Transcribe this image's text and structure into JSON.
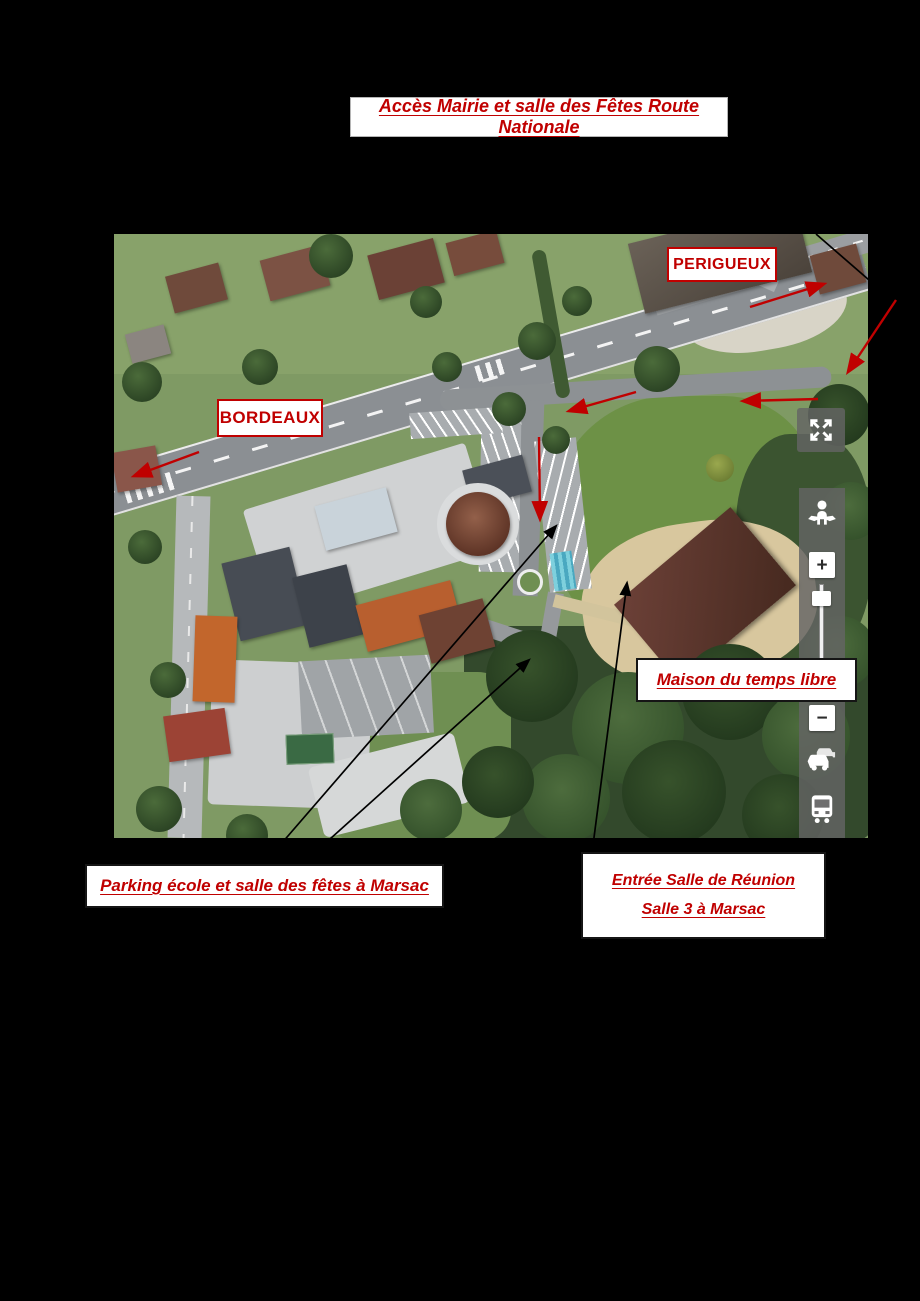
{
  "title": {
    "text": "Accès Mairie et salle des Fêtes Route Nationale"
  },
  "map_labels": {
    "perigueux": "PERIGUEUX",
    "bordeaux": "BORDEAUX",
    "maison_du_temps_libre": "Maison du temps libre"
  },
  "callouts": {
    "parking": "Parking école et salle des fêtes à Marsac",
    "entree_line1": "Entrée Salle de Réunion",
    "entree_line2": "Salle 3  à Marsac"
  },
  "map_controls": {
    "zoom_in": "+",
    "zoom_out": "−",
    "icons": [
      "fullscreen-arrows",
      "street-view-pegman",
      "traffic-car",
      "transit-bus"
    ]
  },
  "colors": {
    "annotation_red": "#C00000",
    "label_border_black": "#151515",
    "page_background": "#000000"
  }
}
